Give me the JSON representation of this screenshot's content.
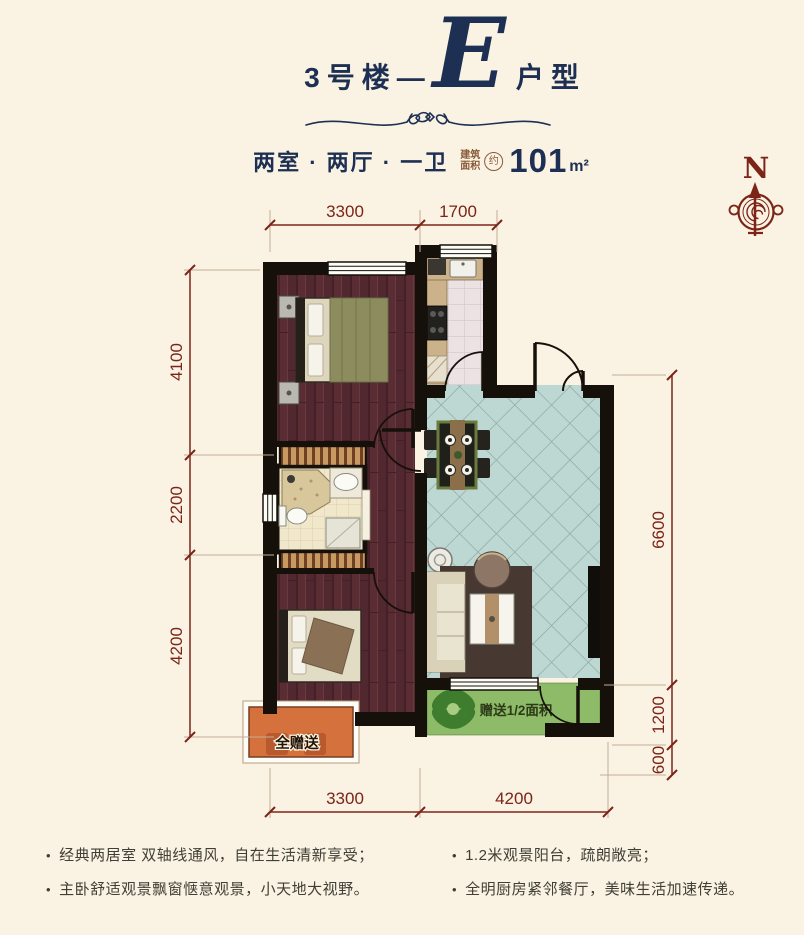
{
  "header": {
    "building": "3号楼",
    "dash": "—",
    "unit_letter": "E",
    "unit_suffix": "户型",
    "layout_summary": "两室 · 两厅 · 一卫",
    "area_label_top": "建筑",
    "area_label_bottom": "面积",
    "area_approx": "约",
    "area_value": "101",
    "area_unit": "m²"
  },
  "compass": {
    "north_label": "N"
  },
  "plan": {
    "room_gift_full_label": "全赠送",
    "balcony_gift_label": "赠送1/2面积",
    "dimensions": {
      "top": [
        "3300",
        "1700"
      ],
      "left": [
        "4100",
        "2200",
        "4200"
      ],
      "right": [
        "6600",
        "1200",
        "600"
      ],
      "bottom": [
        "3300",
        "4200"
      ]
    }
  },
  "features": {
    "left": [
      "经典两居室 双轴线通风，自在生活清新享受；",
      "主卧舒适观景飘窗惬意观景，小天地大视野。"
    ],
    "right": [
      "1.2米观景阳台，疏朗敞亮；",
      "全明厨房紧邻餐厅，美味生活加速传递。"
    ]
  },
  "colors": {
    "background": "#faf2e2",
    "title_navy": "#1d3053",
    "dimension_maroon": "#7c2418",
    "wall_black": "#16100b",
    "wood_floor": "#5a2c33",
    "tile_teal": "#bdd8d3",
    "bath_tile": "#f1e8cc",
    "kitchen_tile": "#ece2e4",
    "balcony_green": "#8dbb67",
    "gift_orange": "#d4713d"
  }
}
